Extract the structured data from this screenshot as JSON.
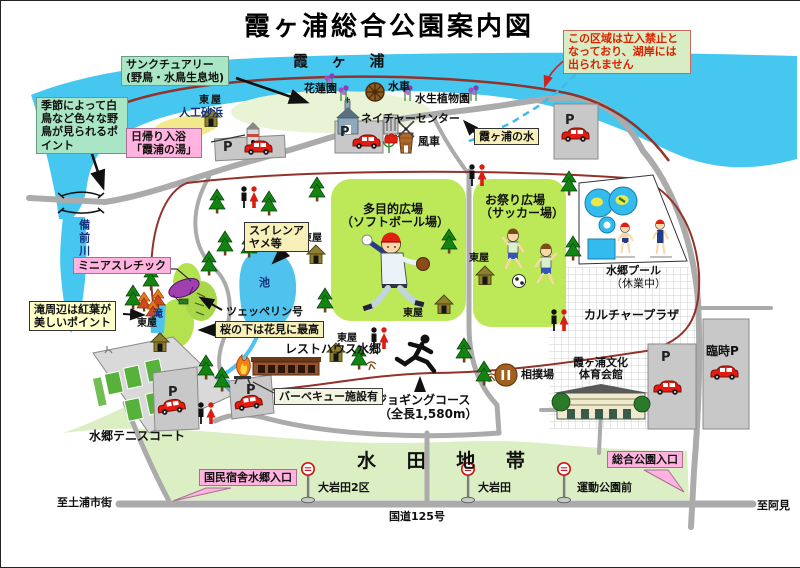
{
  "labels": {
    "title": "霞ヶ浦総合公園案内図",
    "lake": "霞 ヶ 浦",
    "river": "備前川",
    "no_entry": "この区域は立入禁止となっており、湖岸には出られません",
    "sanctuary1": "サンクチュアリー",
    "sanctuary2": "(野鳥・水鳥生息地)",
    "wild_birds": "季節によって白鳥など色々な野鳥が見られるポイント",
    "beach": "人工砂浜",
    "azumaya": "東屋",
    "bath1": "日帰り入浴",
    "bath2": "「霞浦の湯」",
    "lotus": "花蓮園",
    "waterwheel": "水車",
    "aquatic": "水生植物園",
    "nature_center": "ネイチャーセンター",
    "windmill": "風車",
    "lake_water": "霞ヶ浦の水",
    "multi1": "多目的広場",
    "multi2": "（ソフトボール場）",
    "festival1": "お祭り広場",
    "festival2": "（サッカー場）",
    "pool1": "水郷プール",
    "pool2": "（休業中）",
    "culture": "カルチャープラザ",
    "gym1": "霞ヶ浦文化",
    "gym2": "体育会館",
    "temp_p": "臨時P",
    "p": "P",
    "mini_athletic": "ミニアスレチック",
    "autumn1": "滝周辺は紅葉が",
    "autumn2": "美しいポイント",
    "waterfall": "滝",
    "lily1": "スイレンア",
    "lily2": "ヤメ等",
    "pond": "池",
    "zeppelin": "ツェッペリン号",
    "cherry": "桜の下は花見に最高",
    "resthouse": "レストハウス水郷",
    "bbq": "バーベキュー施設有",
    "tennis": "水郷テニスコート",
    "jog1": "ジョギングコース",
    "jog2": "（全長1,580m）",
    "sumo": "相撲場",
    "paddy": "水 田 地 帯",
    "kokumin": "国民宿舎水郷入口",
    "oiwada2": "大岩田2区",
    "oiwada": "大岩田",
    "undokoen": "運動公園前",
    "sogo": "総合公園入口",
    "route": "国道125号",
    "to_tsuchiura": "至土浦市街",
    "to_ami": "至阿見"
  },
  "colors": {
    "lake": "#45C7EF",
    "field_green": "#BDE857",
    "paddy_green": "#DCEFC4",
    "road_gray": "#ABABAB",
    "boundary_maroon": "#93322A",
    "box_pink": "#FFB3DE",
    "box_mint": "#A9E6C5",
    "box_yellow": "#F7F0B9",
    "warning_text": "#DD2200"
  },
  "icons": [
    "pine-tree-icon",
    "autumn-tree-icon",
    "azumaya-hut-icon",
    "car-icon",
    "restroom-icon",
    "bus-stop-icon",
    "windmill-icon",
    "waterwheel-icon",
    "nature-center-icon",
    "tulip-icon",
    "iris-icon",
    "zeppelin-icon",
    "bbq-flame-icon",
    "runner-icon",
    "sumo-ring-icon",
    "baseball-player-icon",
    "soccer-players-icon",
    "swimmers-icon",
    "bridge-icon",
    "parking-icon"
  ]
}
